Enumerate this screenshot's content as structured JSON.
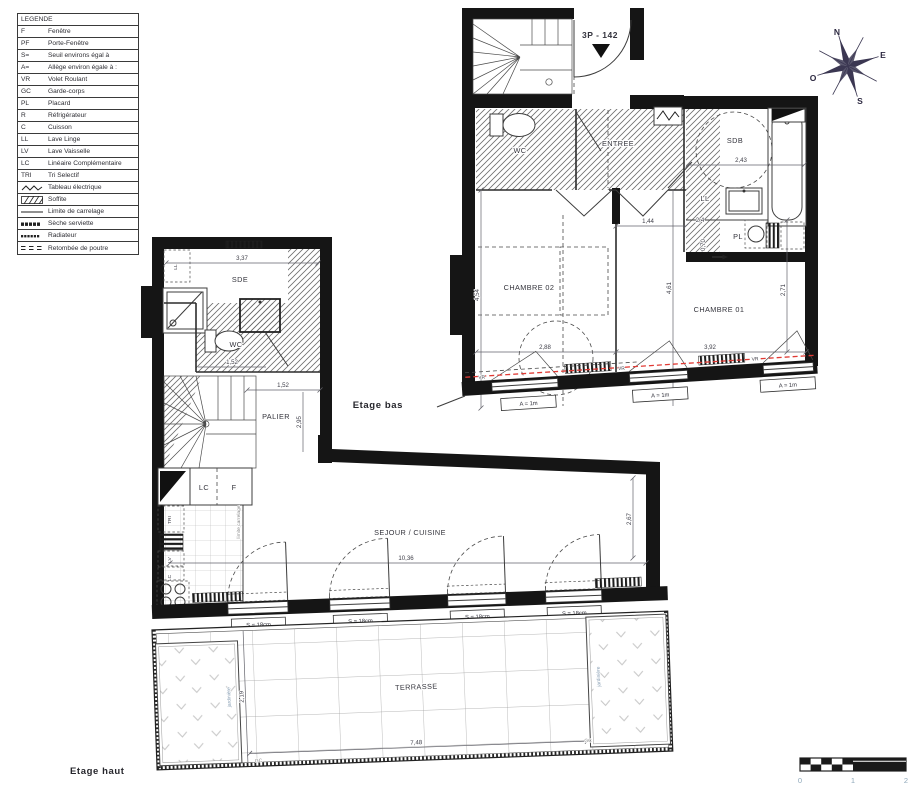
{
  "legend": {
    "title": "LEGENDE",
    "items": [
      {
        "abbr": "F",
        "label": "Fenêtre"
      },
      {
        "abbr": "PF",
        "label": "Porte-Fenêtre"
      },
      {
        "abbr": "S=",
        "label": "Seuil environs égal à"
      },
      {
        "abbr": "A=",
        "label": "Allège environ égale à :"
      },
      {
        "abbr": "VR",
        "label": "Volet Roulant"
      },
      {
        "abbr": "GC",
        "label": "Garde-corps"
      },
      {
        "abbr": "PL",
        "label": "Placard"
      },
      {
        "abbr": "R",
        "label": "Réfrigérateur"
      },
      {
        "abbr": "C",
        "label": "Cuisson"
      },
      {
        "abbr": "LL",
        "label": "Lave Linge"
      },
      {
        "abbr": "LV",
        "label": "Lave Vaisselle"
      },
      {
        "abbr": "LC",
        "label": "Linéaire Complémentaire"
      },
      {
        "abbr": "TRI",
        "label": "Tri Selectif"
      },
      {
        "abbr": "",
        "label": "Tableau électrique",
        "icon": "zigzag"
      },
      {
        "abbr": "",
        "label": "Soffite",
        "icon": "hatch"
      },
      {
        "abbr": "",
        "label": "Limite de carrelage",
        "icon": "line"
      },
      {
        "abbr": "",
        "label": "Sèche serviette",
        "icon": "dash-dense"
      },
      {
        "abbr": "",
        "label": "Radiateur",
        "icon": "dots"
      },
      {
        "abbr": "",
        "label": "Retombée de poutre",
        "icon": "triple-dash"
      }
    ]
  },
  "unit": {
    "code": "3P - 142"
  },
  "compass": {
    "n": "N",
    "e": "E",
    "s": "S",
    "o": "O"
  },
  "scale_bar": {
    "t0": "0",
    "t1": "1",
    "t2": "2"
  },
  "floor_bas": {
    "name": "Etage bas",
    "rooms": {
      "wc": "WC",
      "entree": "ENTREE",
      "sdb": "SDB",
      "ll": "LL",
      "pl": "PL",
      "chambre02": "CHAMBRE 02",
      "chambre01": "CHAMBRE 01"
    },
    "dims": {
      "sdb_w": "2,43",
      "pl_w": "2,4",
      "pl_h": "0,70",
      "nook_w": "1,44",
      "c02_h": "4,54",
      "c02_w": "2,88",
      "c01_w": "3,92",
      "c01_h": "2,71",
      "mid_h": "4,61"
    },
    "window_label": "A = 1m",
    "vr": "VR"
  },
  "floor_haut": {
    "name": "Etage haut",
    "rooms": {
      "sde": "SDE",
      "wc": "WC",
      "palier": "PALIER",
      "sejour": "SEJOUR / CUISINE",
      "terrasse": "TERRASSE"
    },
    "labels": {
      "ll": "LL",
      "lc": "LC",
      "f": "F",
      "tri": "TRI",
      "lv": "LV",
      "lc2": "LC",
      "gc": "GC",
      "jardiniere": "jardinière",
      "limite": "limite carrelage"
    },
    "dims": {
      "sde_w": "3,37",
      "wc_w": "1,52",
      "palier_w": "1,52",
      "palier_h": "2,95",
      "sejour_w": "10,36",
      "sejour_h": "2,67",
      "terrasse_w": "7,48",
      "terrasse_h": "2,19"
    },
    "window_label": "S = 18cm"
  }
}
